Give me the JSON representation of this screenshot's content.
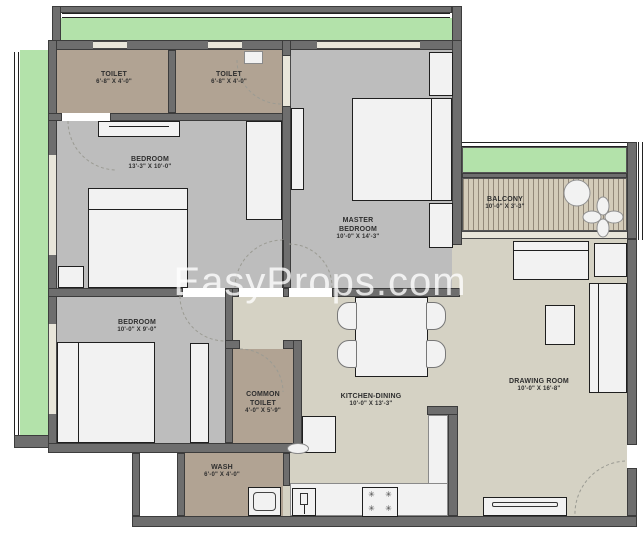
{
  "watermark": "EasyProps.com",
  "colors": {
    "wall": "#6e6e6e",
    "floor-bedroom": "#bdbdbd",
    "floor-toilet": "#b1a393",
    "floor-living": "#d5d2c4",
    "garden": "#b3e2aa",
    "balcony-base": "#d3cbb9",
    "balcony-stripe": "#93897a",
    "furniture": "#f2f2f2",
    "window": "#e9e6da",
    "arc": "#9b9b93",
    "label": "#2e2e2e"
  },
  "glyphs": {
    "burner": "✳"
  },
  "rooms": [
    {
      "id": "toilet-1",
      "name": "TOILET",
      "dims": "6'-8\" X 4'-0\""
    },
    {
      "id": "toilet-2",
      "name": "TOILET",
      "dims": "6'-8\" X 4'-0\""
    },
    {
      "id": "bedroom-1",
      "name": "BEDROOM",
      "dims": "13'-3\" X 10'-0\""
    },
    {
      "id": "master-bedroom",
      "name": "MASTER BEDROOM",
      "dims": "10'-0\" X 14'-3\""
    },
    {
      "id": "balcony",
      "name": "BALCONY",
      "dims": "10'-0\" X 3'-3\""
    },
    {
      "id": "bedroom-2",
      "name": "BEDROOM",
      "dims": "10'-0\" X 9'-0\""
    },
    {
      "id": "common-toilet",
      "name": "COMMON TOILET",
      "dims": "4'-0\" X 5'-9\""
    },
    {
      "id": "kitchen-dining",
      "name": "KITCHEN-DINING",
      "dims": "10'-0\" X 13'-3\""
    },
    {
      "id": "drawing-room",
      "name": "DRAWING ROOM",
      "dims": "10'-0\" X 16'-8\""
    },
    {
      "id": "wash",
      "name": "WASH",
      "dims": "6'-0\" X 4'-0\""
    }
  ]
}
